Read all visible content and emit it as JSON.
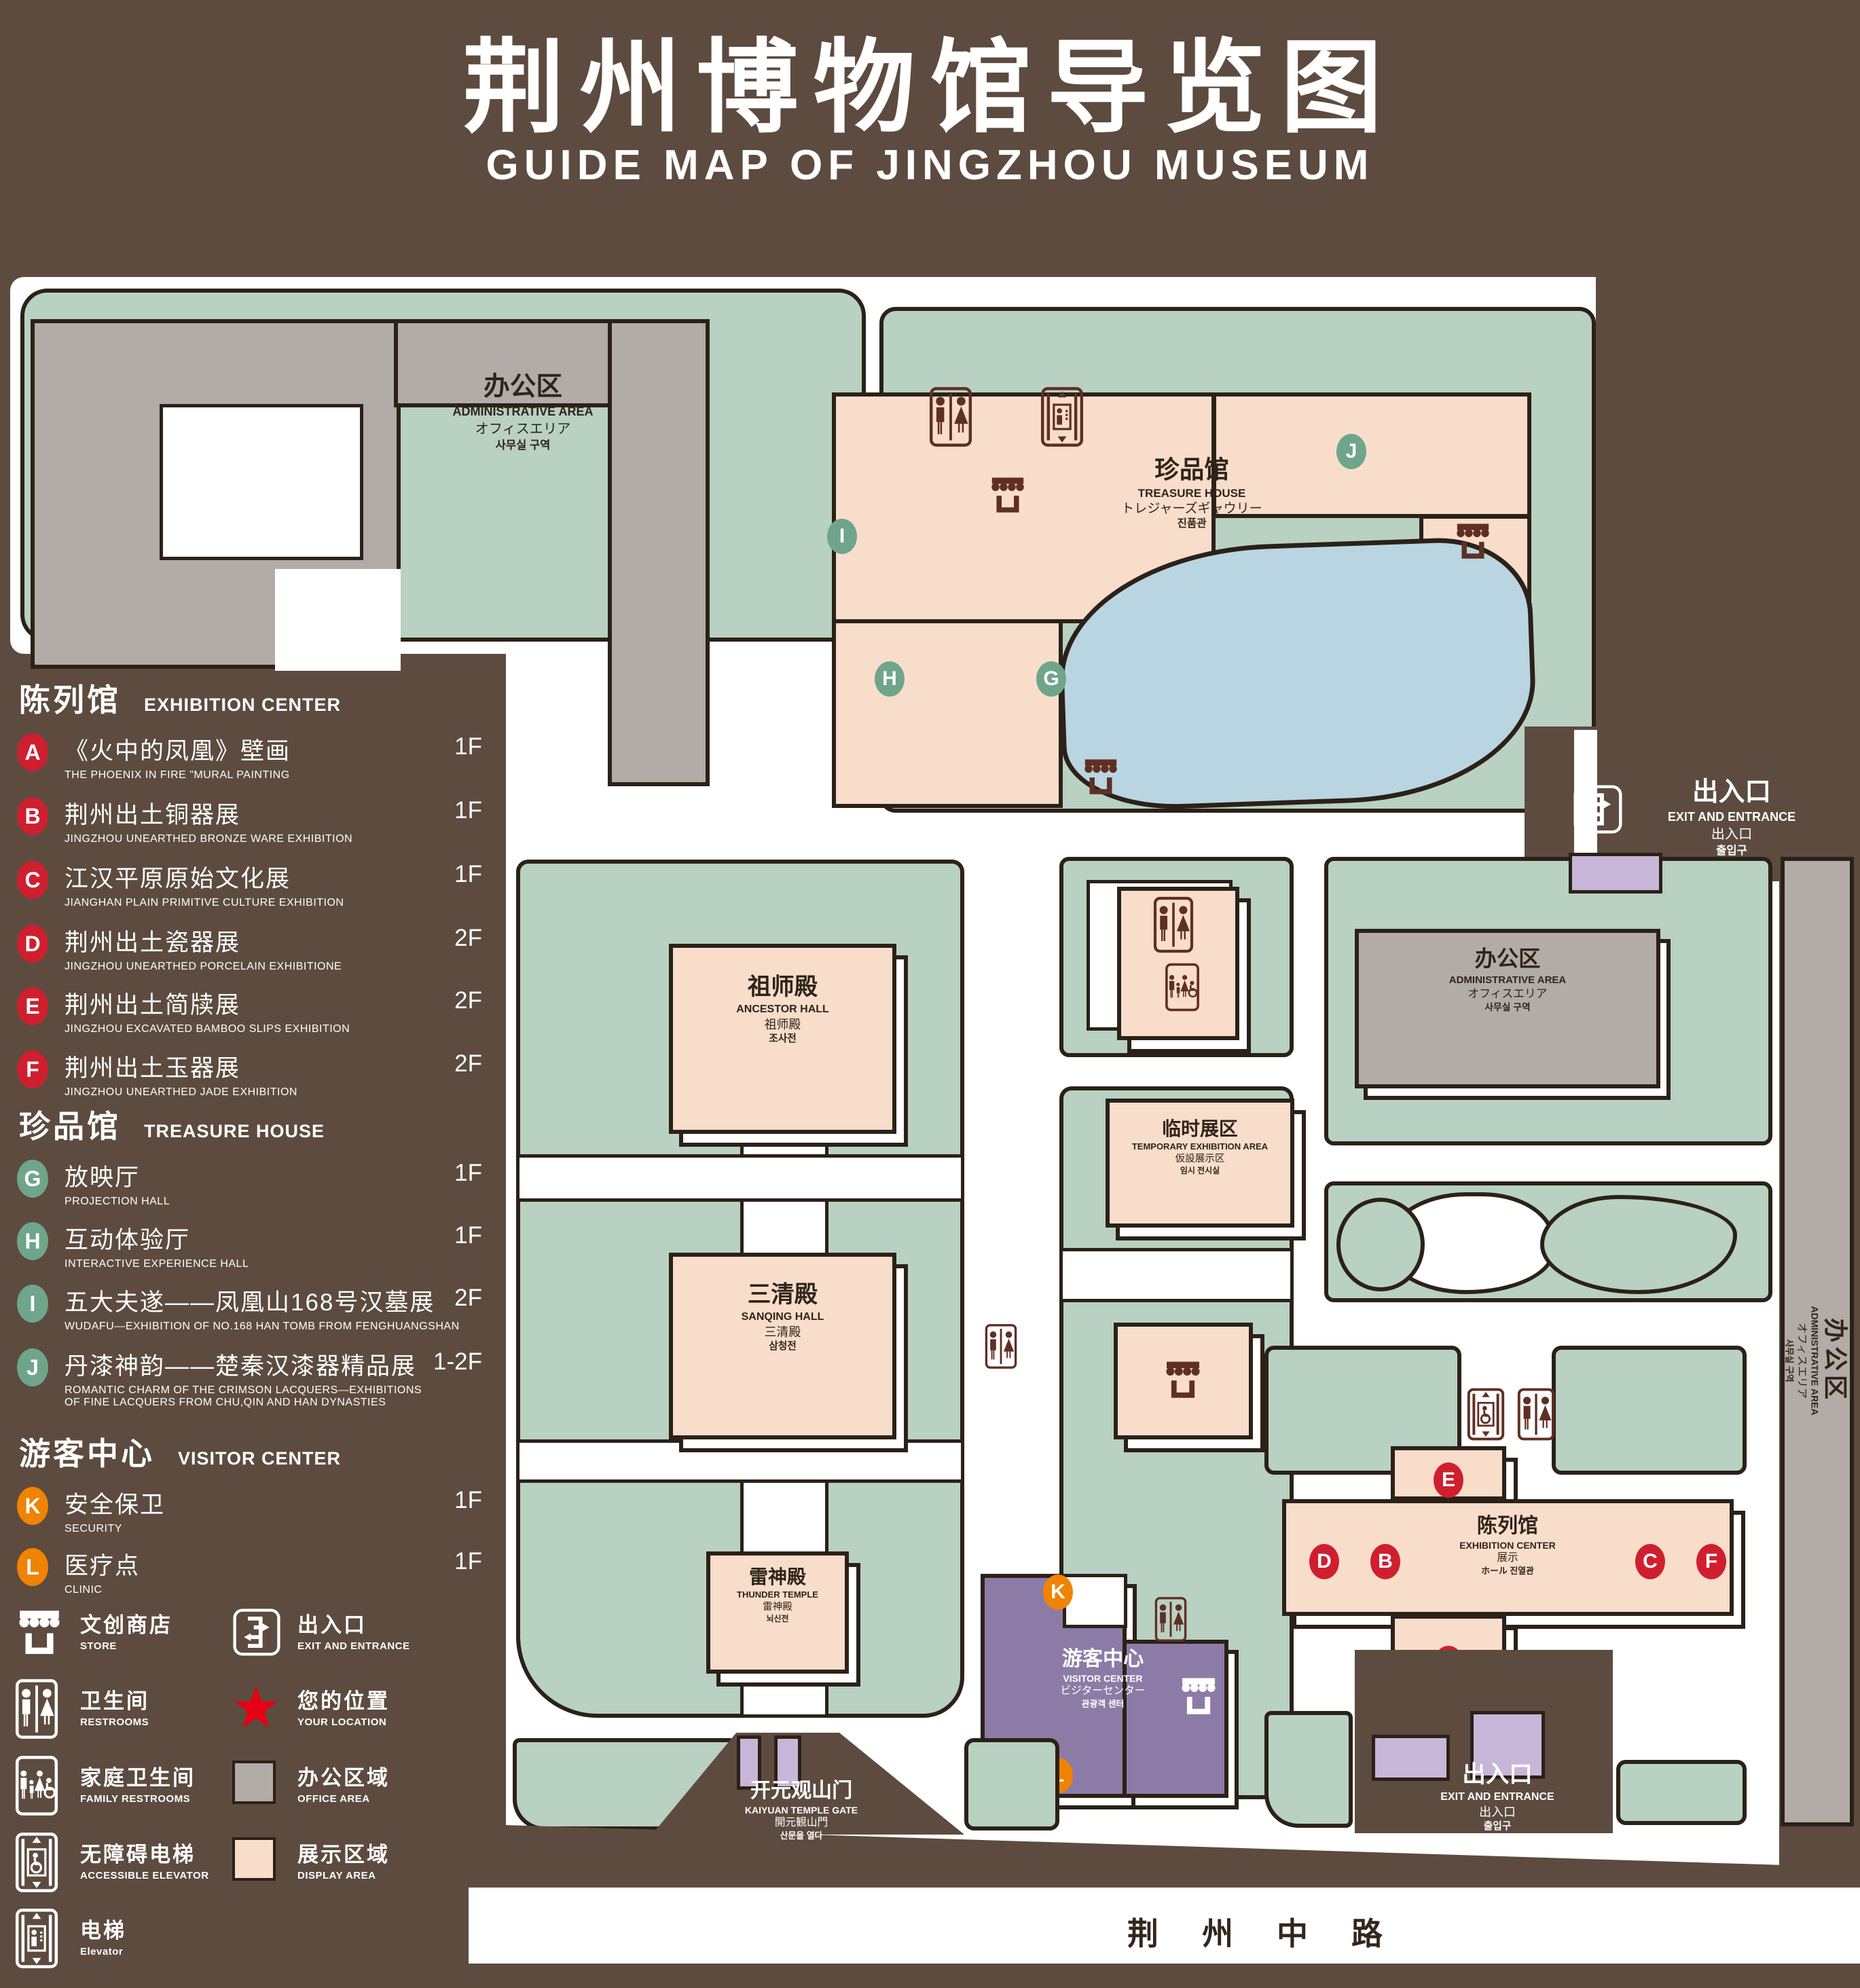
{
  "title": {
    "zh": "荆州博物馆导览图",
    "en": "GUIDE MAP OF JINGZHOU MUSEUM"
  },
  "legend": {
    "sections": [
      {
        "zh": "陈列馆",
        "en": "EXHIBITION CENTER",
        "items": [
          {
            "letter": "A",
            "title": "《火中的凤凰》壁画",
            "sub": "THE PHOENIX IN FIRE \"MURAL PAINTING",
            "floor": "1F"
          },
          {
            "letter": "B",
            "title": "荆州出土铜器展",
            "sub": "JINGZHOU UNEARTHED BRONZE WARE EXHIBITION",
            "floor": "1F"
          },
          {
            "letter": "C",
            "title": "江汉平原原始文化展",
            "sub": "JIANGHAN PLAIN PRIMITIVE CULTURE EXHIBITION",
            "floor": "1F"
          },
          {
            "letter": "D",
            "title": "荆州出土瓷器展",
            "sub": "JINGZHOU UNEARTHED PORCELAIN EXHIBITIONE",
            "floor": "2F"
          },
          {
            "letter": "E",
            "title": "荆州出土简牍展",
            "sub": "JINGZHOU EXCAVATED BAMBOO SLIPS EXHIBITION",
            "floor": "2F"
          },
          {
            "letter": "F",
            "title": "荆州出土玉器展",
            "sub": "JINGZHOU UNEARTHED JADE EXHIBITION",
            "floor": "2F"
          }
        ]
      },
      {
        "zh": "珍品馆",
        "en": "TREASURE HOUSE",
        "items": [
          {
            "letter": "G",
            "title": "放映厅",
            "sub": "PROJECTION HALL",
            "floor": "1F"
          },
          {
            "letter": "H",
            "title": "互动体验厅",
            "sub": "INTERACTIVE EXPERIENCE HALL",
            "floor": "1F"
          },
          {
            "letter": "I",
            "title": "五大夫遂——凤凰山168号汉墓展",
            "sub": "WUDAFU—EXHIBITION OF NO.168 HAN TOMB FROM FENGHUANGSHAN",
            "floor": "2F"
          },
          {
            "letter": "J",
            "title": "丹漆神韵——楚秦汉漆器精品展",
            "sub": "ROMANTIC CHARM OF THE CRIMSON LACQUERS—EXHIBITIONS\nOF FINE LACQUERS FROM CHU,QIN AND HAN DYNASTIES",
            "floor": "1-2F"
          }
        ]
      },
      {
        "zh": "游客中心",
        "en": "VISITOR CENTER",
        "items": [
          {
            "letter": "K",
            "title": "安全保卫",
            "sub": "SECURITY",
            "floor": "1F"
          },
          {
            "letter": "L",
            "title": "医疗点",
            "sub": "CLINIC",
            "floor": "1F"
          }
        ]
      }
    ],
    "symbols": [
      {
        "zh": "文创商店",
        "en": "STORE"
      },
      {
        "zh": "出入口",
        "en": "EXIT AND ENTRANCE"
      },
      {
        "zh": "卫生间",
        "en": "RESTROOMS"
      },
      {
        "zh": "您的位置",
        "en": "YOUR LOCATION"
      },
      {
        "zh": "家庭卫生间",
        "en": "FAMILY RESTROOMS"
      },
      {
        "zh": "办公区域",
        "en": "OFFICE AREA"
      },
      {
        "zh": "无障碍电梯",
        "en": "ACCESSIBLE ELEVATOR"
      },
      {
        "zh": "展示区域",
        "en": "DISPLAY AREA"
      },
      {
        "zh": "电梯",
        "en": "Elevator"
      }
    ]
  },
  "map": {
    "buildings": {
      "admin_northwest": {
        "lines": [
          "办公区",
          "ADMINISTRATIVE AREA",
          "オフィスエリア",
          "사무실 구역"
        ]
      },
      "treasure_house": {
        "lines": [
          "珍品馆",
          "TREASURE HOUSE",
          "トレジャーズギャウリー",
          "진품관"
        ]
      },
      "ancestor_hall": {
        "lines": [
          "祖师殿",
          "ANCESTOR HALL",
          "祖师殿",
          "조사전"
        ]
      },
      "sanqing_hall": {
        "lines": [
          "三清殿",
          "SANQING HALL",
          "三清殿",
          "삼청전"
        ]
      },
      "thunder_temple": {
        "lines": [
          "雷神殿",
          "THUNDER TEMPLE",
          "雷神殿",
          "뇌신전"
        ]
      },
      "temporary_exhibition": {
        "lines": [
          "临时展区",
          "TEMPORARY EXHIBITION AREA",
          "仮設展示区",
          "임시 전시실"
        ]
      },
      "admin_east": {
        "lines": [
          "办公区",
          "ADMINISTRATIVE AREA",
          "オフィスエリア",
          "사무실 구역"
        ]
      },
      "admin_strip": {
        "lines": [
          "办公区",
          "ADMINISTRATIVE AREA",
          "オフィスエリア",
          "사무실 구역"
        ]
      },
      "visitor_center": {
        "lines": [
          "游客中心",
          "VISITOR CENTER",
          "ビジターセンター",
          "관광객 센터"
        ]
      },
      "exhibition_center": {
        "lines": [
          "陈列馆",
          "EXHIBITION CENTER",
          "展示",
          "ホール 진열관"
        ]
      }
    },
    "gate": {
      "lines": [
        "开元观山门",
        "KAIYUAN TEMPLE GATE",
        "開元観山門",
        "산문을 열다"
      ]
    },
    "exits": {
      "east": {
        "lines": [
          "出入口",
          "EXIT AND ENTRANCE",
          "出入口",
          "출입구"
        ]
      },
      "south": {
        "lines": [
          "出入口",
          "EXIT AND ENTRANCE",
          "出入口",
          "출입구"
        ]
      }
    },
    "road": "荆州中路",
    "your_location": "您的位置",
    "markers": {
      "A": {
        "letter": "A"
      },
      "B": {
        "letter": "B"
      },
      "C": {
        "letter": "C"
      },
      "D": {
        "letter": "D"
      },
      "E": {
        "letter": "E"
      },
      "F": {
        "letter": "F"
      },
      "G": {
        "letter": "G"
      },
      "H": {
        "letter": "H"
      },
      "I": {
        "letter": "I"
      },
      "J": {
        "letter": "J"
      },
      "K": {
        "letter": "K"
      },
      "L": {
        "letter": "L"
      }
    }
  },
  "colors": {
    "page_brown": "#5d4b3f",
    "outline": "#2b2118",
    "campus_green": "#b9d1c2",
    "display_pink": "#f9ddcb",
    "office_gray": "#b2aba7",
    "visitor_purple": "#8d7ba7",
    "gate_purple": "#c8b6d8",
    "pond_blue": "#b9d5e2",
    "icon_maroon": "#5f2f24",
    "marker_red": "#cf1f2f",
    "marker_green": "#6fa58b",
    "marker_orange": "#f08300",
    "location_red": "#e60012"
  }
}
